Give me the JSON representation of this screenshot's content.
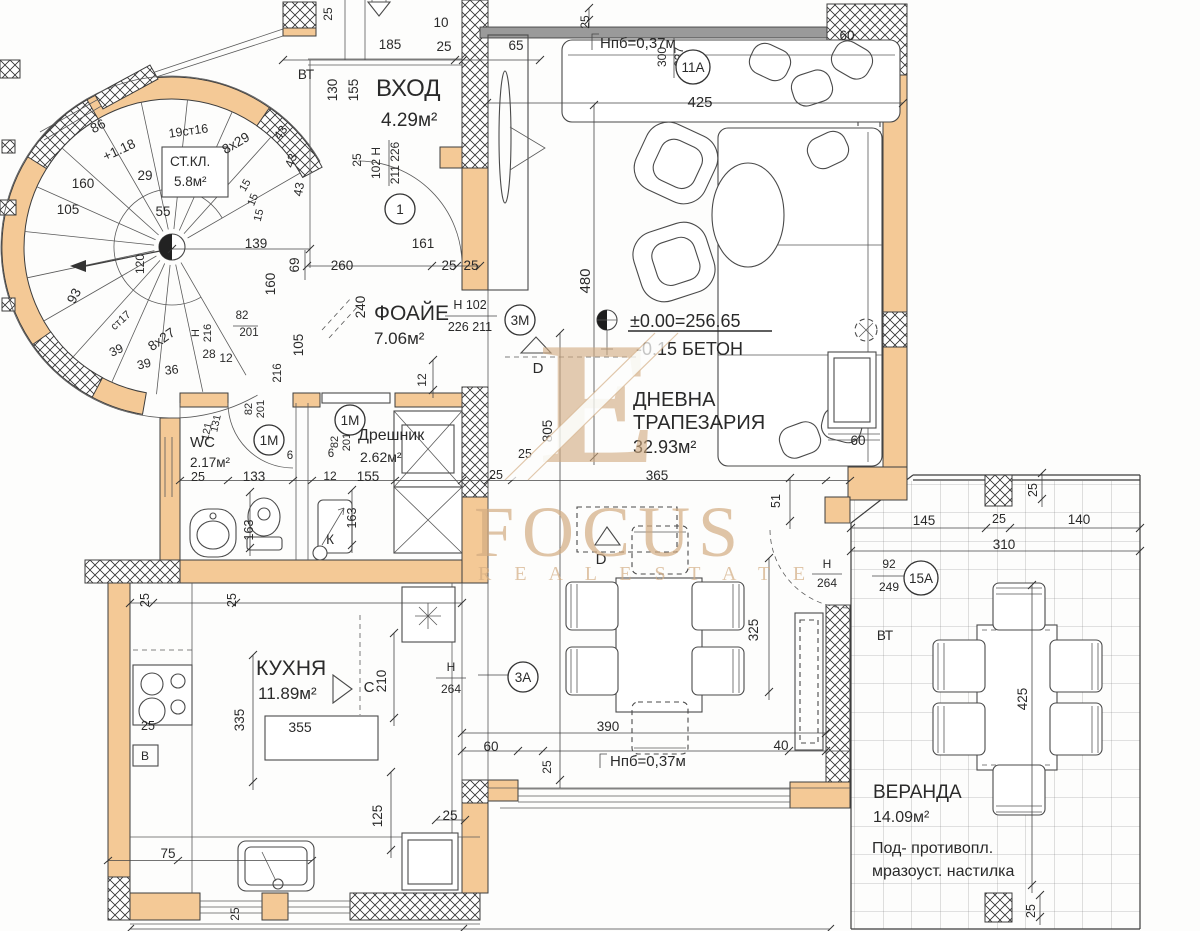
{
  "watermark": {
    "brand": "FOCUS",
    "tagline": "R E A L    E S T A T E",
    "monogram": "E"
  },
  "levels": {
    "benchmark": "±0.00=256.65",
    "slab": "-0.15 БЕТОН",
    "parapet": "Нпб=0,37м"
  },
  "rooms": {
    "vhod": {
      "name": "ВХОД",
      "area": "4.29м²"
    },
    "stkl": {
      "name": "СТ.КЛ.",
      "area": "5.8м²"
    },
    "foyer": {
      "name": "ФОАЙЕ",
      "area": "7.06м²"
    },
    "wc": {
      "name": "WC",
      "area": "2.17м²"
    },
    "dreshnik": {
      "name": "Дрешник",
      "area": "2.62м²"
    },
    "kitchen": {
      "name": "КУХНЯ",
      "area": "11.89м²"
    },
    "living": {
      "name": "ДНЕВНА",
      "name2": "ТРАПЕЗАРИЯ",
      "area": "32.93м²"
    },
    "veranda": {
      "name": "ВЕРАНДА",
      "area": "14.09м²",
      "note1": "Под- противопл.",
      "note2": "мразоуст. настилка"
    }
  },
  "tags": [
    {
      "label": "1",
      "x": 400,
      "y": 209
    },
    {
      "label": "3М",
      "x": 520,
      "y": 320
    },
    {
      "label": "11А",
      "x": 693,
      "y": 67
    },
    {
      "label": "3А",
      "x": 523,
      "y": 677
    },
    {
      "label": "15А",
      "x": 921,
      "y": 578
    },
    {
      "label": "1М",
      "x": 269,
      "y": 440
    },
    {
      "label": "1М",
      "x": 350,
      "y": 420
    }
  ],
  "annotations": [
    {
      "t": "25",
      "x": 332,
      "y": 14,
      "r": -90,
      "s": 12
    },
    {
      "t": "ВТ",
      "x": 306,
      "y": 79
    },
    {
      "t": "86",
      "x": 100,
      "y": 130,
      "r": -28
    },
    {
      "t": "+1.18",
      "x": 121,
      "y": 154,
      "r": -25
    },
    {
      "t": "19ст16",
      "x": 189,
      "y": 135,
      "r": -8,
      "s": 12.5
    },
    {
      "t": "8х29",
      "x": 238,
      "y": 147,
      "r": -30
    },
    {
      "t": "43",
      "x": 284,
      "y": 135,
      "r": -55,
      "s": 12.5
    },
    {
      "t": "43",
      "x": 295,
      "y": 162,
      "r": -70,
      "s": 12.5
    },
    {
      "t": "43",
      "x": 303,
      "y": 190,
      "r": -80,
      "s": 12.5
    },
    {
      "t": "160",
      "x": 83,
      "y": 188
    },
    {
      "t": "29",
      "x": 145,
      "y": 180
    },
    {
      "t": "105",
      "x": 68,
      "y": 214
    },
    {
      "t": "55",
      "x": 163,
      "y": 216
    },
    {
      "t": "15",
      "x": 248,
      "y": 187,
      "r": -60,
      "s": 11
    },
    {
      "t": "15",
      "x": 256,
      "y": 201,
      "r": -68,
      "s": 11
    },
    {
      "t": "15",
      "x": 262,
      "y": 216,
      "r": -76,
      "s": 11
    },
    {
      "t": "139",
      "x": 256,
      "y": 248
    },
    {
      "t": "93",
      "x": 78,
      "y": 298,
      "r": -62
    },
    {
      "t": "120",
      "x": 144,
      "y": 264,
      "r": -90,
      "s": 12
    },
    {
      "t": "ст17",
      "x": 123,
      "y": 323,
      "r": -42,
      "s": 11
    },
    {
      "t": "8х27",
      "x": 164,
      "y": 343,
      "r": -35
    },
    {
      "t": "39",
      "x": 118,
      "y": 354,
      "r": -25,
      "s": 12.5
    },
    {
      "t": "39",
      "x": 145,
      "y": 368,
      "r": -14,
      "s": 12.5
    },
    {
      "t": "36",
      "x": 172,
      "y": 374,
      "r": -6,
      "s": 12.5
    },
    {
      "t": "160",
      "x": 275,
      "y": 284,
      "r": -90
    },
    {
      "t": "105",
      "x": 303,
      "y": 345,
      "r": -90
    },
    {
      "t": "82",
      "x": 242,
      "y": 319,
      "s": 11.5
    },
    {
      "t": "201",
      "x": 249,
      "y": 336,
      "s": 11.5
    },
    {
      "t": "Н",
      "x": 199,
      "y": 333,
      "r": -90,
      "s": 11
    },
    {
      "t": "216",
      "x": 211,
      "y": 333,
      "r": -90,
      "s": 11
    },
    {
      "t": "28",
      "x": 209,
      "y": 358,
      "s": 12
    },
    {
      "t": "12",
      "x": 226,
      "y": 362,
      "s": 12
    },
    {
      "t": "216",
      "x": 281,
      "y": 373,
      "r": -90,
      "s": 11.5
    },
    {
      "t": "82",
      "x": 252,
      "y": 409,
      "r": -90,
      "s": 11
    },
    {
      "t": "201",
      "x": 264,
      "y": 409,
      "r": -90,
      "s": 11
    },
    {
      "t": "185",
      "x": 390,
      "y": 49
    },
    {
      "t": "10",
      "x": 441,
      "y": 27
    },
    {
      "t": "25",
      "x": 444,
      "y": 51
    },
    {
      "t": "65",
      "x": 516,
      "y": 50
    },
    {
      "t": "130",
      "x": 337,
      "y": 90,
      "r": -90
    },
    {
      "t": "155",
      "x": 358,
      "y": 90,
      "r": -90
    },
    {
      "t": "25",
      "x": 361,
      "y": 160,
      "r": -90,
      "s": 12
    },
    {
      "t": "102 Н",
      "x": 380,
      "y": 163,
      "r": -90,
      "s": 12
    },
    {
      "t": "211 226",
      "x": 399,
      "y": 163,
      "r": -90,
      "s": 12
    },
    {
      "t": "161",
      "x": 423,
      "y": 248
    },
    {
      "t": "260",
      "x": 342,
      "y": 270
    },
    {
      "t": "25",
      "x": 449,
      "y": 270
    },
    {
      "t": "25",
      "x": 471,
      "y": 270
    },
    {
      "t": "69",
      "x": 299,
      "y": 265,
      "r": -90
    },
    {
      "t": "25",
      "x": 589,
      "y": 22,
      "r": -90,
      "s": 12
    },
    {
      "t": "300",
      "x": 666,
      "y": 57,
      "r": -90,
      "s": 12
    },
    {
      "t": "227",
      "x": 683,
      "y": 57,
      "r": -90,
      "s": 12
    },
    {
      "t": "425",
      "x": 700,
      "y": 107,
      "s": 15
    },
    {
      "t": "60",
      "x": 847,
      "y": 40
    },
    {
      "t": "480",
      "x": 590,
      "y": 281,
      "r": -90,
      "s": 15
    },
    {
      "t": "365",
      "x": 657,
      "y": 480
    },
    {
      "t": "25",
      "x": 496,
      "y": 479,
      "s": 12.5
    },
    {
      "t": "51",
      "x": 780,
      "y": 501,
      "r": -90,
      "s": 12.5
    },
    {
      "t": "60",
      "x": 858,
      "y": 445
    },
    {
      "t": "325",
      "x": 758,
      "y": 630,
      "r": -90
    },
    {
      "t": "390",
      "x": 608,
      "y": 731
    },
    {
      "t": "60",
      "x": 491,
      "y": 751
    },
    {
      "t": "25",
      "x": 551,
      "y": 767,
      "r": -90,
      "s": 12
    },
    {
      "t": "40",
      "x": 781,
      "y": 750
    },
    {
      "t": "Н",
      "x": 827,
      "y": 568,
      "s": 12
    },
    {
      "t": "264",
      "x": 827,
      "y": 587,
      "s": 12
    },
    {
      "t": "D",
      "x": 538,
      "y": 373,
      "s": 15
    },
    {
      "t": "D",
      "x": 601,
      "y": 564,
      "s": 15
    },
    {
      "t": "805",
      "x": 552,
      "y": 431,
      "r": -90
    },
    {
      "t": "240",
      "x": 365,
      "y": 307,
      "r": -90
    },
    {
      "t": "Н 102",
      "x": 470,
      "y": 309,
      "s": 12.5
    },
    {
      "t": "226 211",
      "x": 470,
      "y": 331,
      "s": 12.5
    },
    {
      "t": "12",
      "x": 426,
      "y": 380,
      "r": -90,
      "s": 12
    },
    {
      "t": "25",
      "x": 525,
      "y": 458,
      "s": 12.5
    },
    {
      "t": "25",
      "x": 198,
      "y": 481,
      "s": 12.5
    },
    {
      "t": "133",
      "x": 254,
      "y": 481
    },
    {
      "t": "163",
      "x": 253,
      "y": 530,
      "r": -90,
      "s": 12.5
    },
    {
      "t": "131",
      "x": 219,
      "y": 424,
      "r": -78,
      "s": 10.5
    },
    {
      "t": "121",
      "x": 210,
      "y": 432,
      "r": -78,
      "s": 10.5
    },
    {
      "t": "6",
      "x": 290,
      "y": 459,
      "s": 11.5
    },
    {
      "t": "155",
      "x": 368,
      "y": 481
    },
    {
      "t": "163",
      "x": 356,
      "y": 518,
      "r": -90,
      "s": 12.5
    },
    {
      "t": "12",
      "x": 330,
      "y": 480,
      "s": 12
    },
    {
      "t": "6",
      "x": 331,
      "y": 457,
      "s": 11.5
    },
    {
      "t": "82",
      "x": 338,
      "y": 442,
      "r": -90,
      "s": 11
    },
    {
      "t": "201",
      "x": 350,
      "y": 442,
      "r": -90,
      "s": 11
    },
    {
      "t": "К",
      "x": 330,
      "y": 544,
      "s": 13.5
    },
    {
      "t": "С",
      "x": 369,
      "y": 692,
      "s": 15
    },
    {
      "t": "210",
      "x": 386,
      "y": 681,
      "r": -90
    },
    {
      "t": "335",
      "x": 244,
      "y": 720,
      "r": -90
    },
    {
      "t": "355",
      "x": 300,
      "y": 732,
      "s": 14
    },
    {
      "t": "25",
      "x": 149,
      "y": 600,
      "r": -90,
      "s": 12.5
    },
    {
      "t": "25",
      "x": 236,
      "y": 600,
      "r": -90,
      "s": 12.5
    },
    {
      "t": "25",
      "x": 148,
      "y": 730,
      "s": 12.5
    },
    {
      "t": "В",
      "x": 145,
      "y": 760,
      "s": 12
    },
    {
      "t": "Н",
      "x": 451,
      "y": 671,
      "s": 12
    },
    {
      "t": "264",
      "x": 451,
      "y": 693,
      "s": 12
    },
    {
      "t": "125",
      "x": 382,
      "y": 816,
      "r": -90
    },
    {
      "t": "25",
      "x": 450,
      "y": 820
    },
    {
      "t": "75",
      "x": 168,
      "y": 858
    },
    {
      "t": "25",
      "x": 239,
      "y": 914,
      "r": -90,
      "s": 12
    },
    {
      "t": "145",
      "x": 924,
      "y": 525
    },
    {
      "t": "25",
      "x": 999,
      "y": 523,
      "s": 12.5
    },
    {
      "t": "140",
      "x": 1079,
      "y": 524
    },
    {
      "t": "310",
      "x": 1004,
      "y": 549
    },
    {
      "t": "25",
      "x": 1037,
      "y": 490,
      "r": -90,
      "s": 12.5
    },
    {
      "t": "92",
      "x": 889,
      "y": 568,
      "s": 12
    },
    {
      "t": "249",
      "x": 889,
      "y": 591,
      "s": 12
    },
    {
      "t": "ВТ",
      "x": 885,
      "y": 640
    },
    {
      "t": "425",
      "x": 1027,
      "y": 699,
      "r": -90
    },
    {
      "t": "25",
      "x": 1035,
      "y": 911,
      "r": -90,
      "s": 12.5
    }
  ]
}
